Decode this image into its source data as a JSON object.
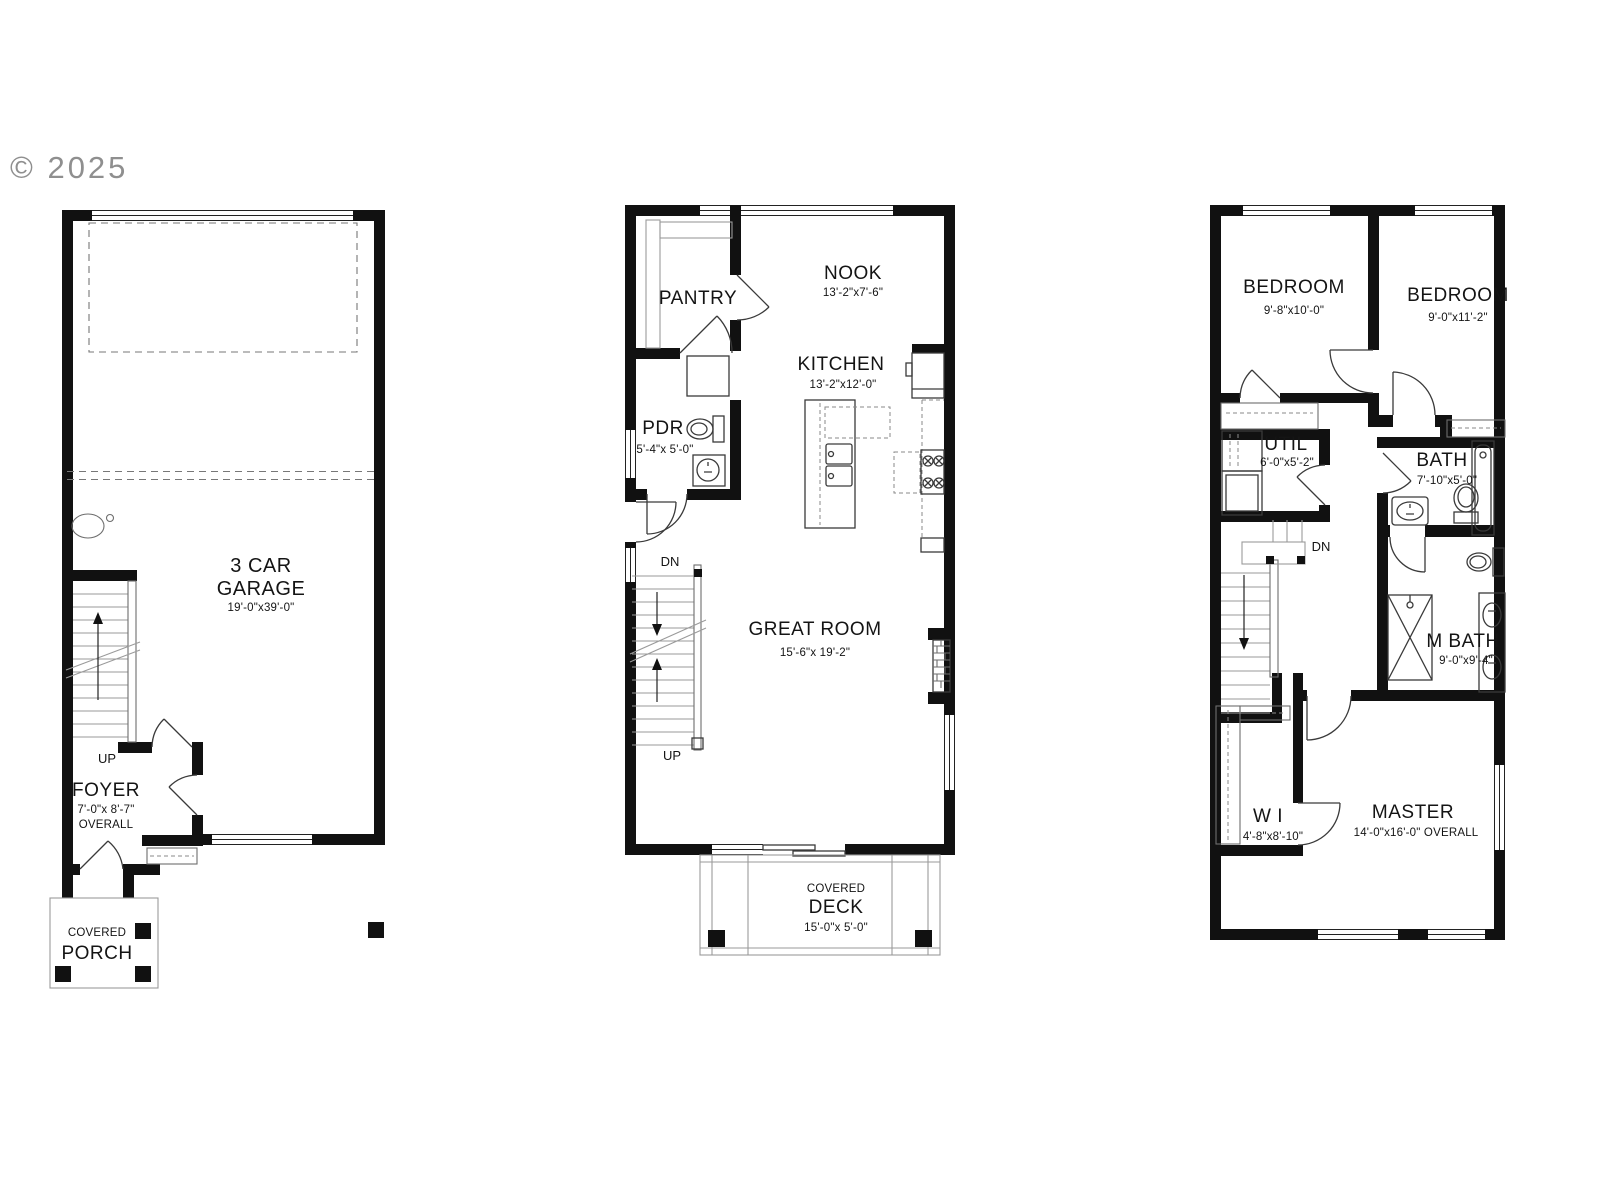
{
  "copyright": "© 2025",
  "colors": {
    "wall": "#111111",
    "background": "#ffffff",
    "watermark": "#8f8f8f"
  },
  "plan_garage": {
    "garage_l1": "3 CAR",
    "garage_l2": "GARAGE",
    "garage_dims": "19'-0\"x39'-0\"",
    "up": "UP",
    "foyer": "FOYER",
    "foyer_dims": "7'-0\"x 8'-7\"",
    "foyer_overall": "OVERALL",
    "porch_l1": "COVERED",
    "porch_l2": "PORCH"
  },
  "plan_main": {
    "pantry": "PANTRY",
    "nook": "NOOK",
    "nook_dims": "13'-2\"x7'-6\"",
    "kitchen": "KITCHEN",
    "kitchen_dims": "13'-2\"x12'-0\"",
    "pdr": "PDR",
    "pdr_dims": "5'-4\"x 5'-0\"",
    "dn": "DN",
    "up": "UP",
    "great_room": "GREAT ROOM",
    "great_room_dims": "15'-6\"x 19'-2\"",
    "deck_l1": "COVERED",
    "deck_l2": "DECK",
    "deck_dims": "15'-0\"x 5'-0\""
  },
  "plan_upper": {
    "bedroom1": "BEDROOM",
    "bedroom1_dims": "9'-8\"x10'-0\"",
    "bedroom2": "BEDROOM",
    "bedroom2_dims": "9'-0\"x11'-2\"",
    "util": "UTIL",
    "util_dims": "6'-0\"x5'-2\"",
    "bath": "BATH",
    "bath_dims": "7'-10\"x5'-0\"",
    "dn": "DN",
    "mbath": "M BATH",
    "mbath_dims": "9'-0\"x9'-4\"",
    "wi": "W I",
    "wi_dims": "4'-8\"x8'-10\"",
    "master": "MASTER",
    "master_dims": "14'-0\"x16'-0\" OVERALL"
  }
}
